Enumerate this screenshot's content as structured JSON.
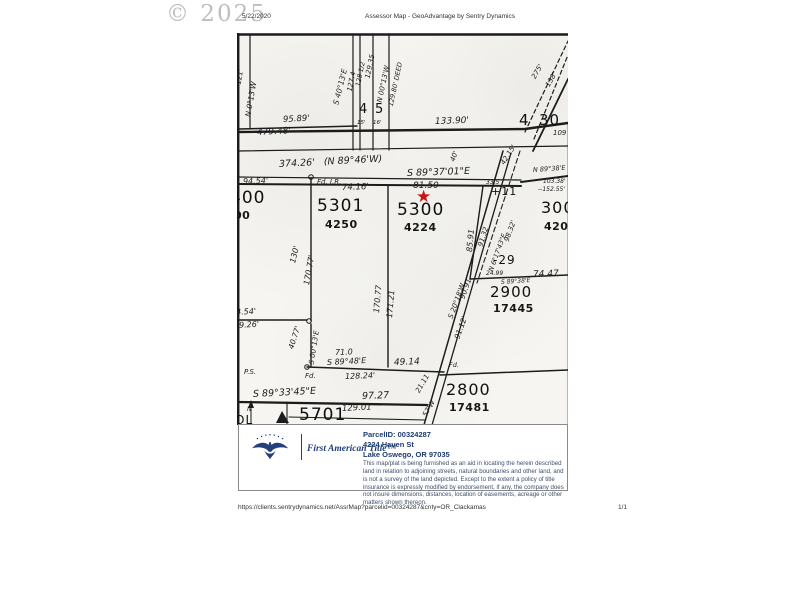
{
  "watermark": "© 2025",
  "header": {
    "date": "5/22/2020",
    "title": "Assessor Map - GeoAdvantage by Sentry Dynamics"
  },
  "footer": {
    "url": "https://clients.sentrydynamics.net/AssrMap?parcelid=00324287&cnty=OR_Clackamas",
    "page": "1/1"
  },
  "info_panel": {
    "brand": "First American Title™",
    "parcel_id": "ParcelID: 00324287",
    "address1": "4224 Haven St",
    "address2": "Lake Oswego, OR  97035",
    "disclaimer": "This map/plat is being furnished as an aid in locating the herein described land in relation to adjoining streets, natural boundaries and other land, and is not a survey of the land depicted. Except to the extent a policy of title insurance is expressly modified by endorsement, if any, the company does not insure dimensions, distances, location of easements, acreage or other matters shown thereon."
  },
  "map": {
    "star_glyph": "★",
    "star_color": "#c81414",
    "labels": [
      {
        "t": "121'",
        "x": 2,
        "y": 48,
        "s": 7,
        "r": -80,
        "c": "d"
      },
      {
        "t": "N 0°13'W",
        "x": 11,
        "y": 80,
        "s": 7.5,
        "r": -80,
        "c": "d"
      },
      {
        "t": "95.89'",
        "x": 46,
        "y": 83,
        "s": 8.5,
        "r": -3,
        "c": "d"
      },
      {
        "t": "479.48'",
        "x": 20,
        "y": 96,
        "s": 9,
        "r": -3,
        "c": "d"
      },
      {
        "t": "S 40°13'E",
        "x": 99,
        "y": 68,
        "s": 7.5,
        "r": -76,
        "c": "d"
      },
      {
        "t": "127.4",
        "x": 113,
        "y": 55,
        "s": 7,
        "r": -78,
        "c": "d"
      },
      {
        "t": "128 1/2",
        "x": 121,
        "y": 50,
        "s": 6.5,
        "r": -78,
        "c": "d"
      },
      {
        "t": "129.35",
        "x": 131,
        "y": 42,
        "s": 7,
        "r": -78,
        "c": "d"
      },
      {
        "t": "N 00°13'W",
        "x": 143,
        "y": 66,
        "s": 7,
        "r": -78,
        "c": "d"
      },
      {
        "t": "129.80' DEED",
        "x": 154,
        "y": 70,
        "s": 6.5,
        "r": -78,
        "c": "d"
      },
      {
        "t": "4",
        "x": 122,
        "y": 70,
        "s": 13,
        "c": "p"
      },
      {
        "t": "5",
        "x": 138,
        "y": 70,
        "s": 13,
        "c": "p"
      },
      {
        "t": "15'",
        "x": 120,
        "y": 88,
        "s": 5.5,
        "c": "d"
      },
      {
        "t": "16'",
        "x": 136,
        "y": 88,
        "s": 5.5,
        "c": "d"
      },
      {
        "t": "133.90'",
        "x": 198,
        "y": 85,
        "s": 9,
        "r": -2,
        "c": "d"
      },
      {
        "t": "4",
        "x": 282,
        "y": 80,
        "s": 15,
        "c": "p"
      },
      {
        "t": "30",
        "x": 302,
        "y": 80,
        "s": 15,
        "c": "p"
      },
      {
        "t": "275'",
        "x": 297,
        "y": 42,
        "s": 7,
        "r": -60,
        "c": "d"
      },
      {
        "t": "138'",
        "x": 311,
        "y": 50,
        "s": 7,
        "r": -60,
        "c": "d"
      },
      {
        "t": "109",
        "x": 316,
        "y": 97,
        "s": 7,
        "c": "d"
      },
      {
        "t": "374.26'   (N 89°46'W)",
        "x": 42,
        "y": 127,
        "s": 9.5,
        "r": -3,
        "c": "d"
      },
      {
        "t": "S 89°37'01\"E",
        "x": 170,
        "y": 136,
        "s": 9.5,
        "r": -2,
        "c": "d"
      },
      {
        "t": "40'",
        "x": 216,
        "y": 125,
        "s": 7,
        "r": -70,
        "c": "d"
      },
      {
        "t": "42.15'",
        "x": 266,
        "y": 128,
        "s": 7,
        "r": -58,
        "c": "d"
      },
      {
        "t": "N 89°38'E",
        "x": 296,
        "y": 134,
        "s": 6.5,
        "r": -4,
        "c": "d"
      },
      {
        "t": "103.38'",
        "x": 306,
        "y": 146,
        "s": 6,
        "c": "d"
      },
      {
        "t": "--152.55'",
        "x": 301,
        "y": 154,
        "s": 6,
        "c": "d"
      },
      {
        "t": "94.54'",
        "x": 6,
        "y": 145,
        "s": 8,
        "r": -2,
        "c": "d"
      },
      {
        "t": "Fd. I.R.",
        "x": 80,
        "y": 146,
        "s": 7,
        "c": "d"
      },
      {
        "t": "74.16'",
        "x": 105,
        "y": 151,
        "s": 8.5,
        "r": -2,
        "c": "d"
      },
      {
        "t": "81.50",
        "x": 176,
        "y": 149,
        "s": 9,
        "c": "d"
      },
      {
        "t": "33.5",
        "x": 249,
        "y": 147,
        "s": 6,
        "c": "d"
      },
      {
        "t": "+11",
        "x": 254,
        "y": 153,
        "s": 11,
        "c": "p"
      },
      {
        "t": "400",
        "x": -7,
        "y": 157,
        "s": 17,
        "c": "p"
      },
      {
        "t": "00",
        "x": -3,
        "y": 177,
        "s": 11,
        "c": "t"
      },
      {
        "t": "5301",
        "x": 80,
        "y": 165,
        "s": 17,
        "c": "p"
      },
      {
        "t": "4250",
        "x": 88,
        "y": 186,
        "s": 11,
        "c": "t"
      },
      {
        "t": "5300",
        "x": 160,
        "y": 169,
        "s": 17,
        "c": "p"
      },
      {
        "t": "4224",
        "x": 167,
        "y": 189,
        "s": 11,
        "c": "t"
      },
      {
        "t": "3000",
        "x": 304,
        "y": 167,
        "s": 16,
        "c": "p"
      },
      {
        "t": "4208",
        "x": 307,
        "y": 188,
        "s": 11,
        "c": "t"
      },
      {
        "t": "85.91",
        "x": 233,
        "y": 215,
        "s": 8,
        "r": -85,
        "c": "d"
      },
      {
        "t": "91.32",
        "x": 244,
        "y": 210,
        "s": 7,
        "r": -73,
        "c": "d"
      },
      {
        "t": "98.32'",
        "x": 270,
        "y": 205,
        "s": 7,
        "r": -70,
        "c": "d"
      },
      {
        "t": "N 6°17'43\"E",
        "x": 254,
        "y": 235,
        "s": 6.5,
        "r": -70,
        "c": "d"
      },
      {
        "t": "-29",
        "x": 256,
        "y": 221,
        "s": 12,
        "c": "p"
      },
      {
        "t": "24.99",
        "x": 249,
        "y": 238,
        "s": 6,
        "c": "d"
      },
      {
        "t": "74.47",
        "x": 296,
        "y": 238,
        "s": 9,
        "r": -2,
        "c": "d"
      },
      {
        "t": "S 89°38'E",
        "x": 264,
        "y": 247,
        "s": 6,
        "r": -4,
        "c": "d"
      },
      {
        "t": "2900",
        "x": 253,
        "y": 252,
        "s": 15,
        "c": "p"
      },
      {
        "t": "17445",
        "x": 256,
        "y": 270,
        "s": 11,
        "c": "t"
      },
      {
        "t": "130'",
        "x": 56,
        "y": 226,
        "s": 8,
        "r": -76,
        "c": "d"
      },
      {
        "t": "170.77'",
        "x": 70,
        "y": 248,
        "s": 8,
        "r": -80,
        "c": "d"
      },
      {
        "t": "170.77",
        "x": 140,
        "y": 276,
        "s": 8,
        "r": -85,
        "c": "d"
      },
      {
        "t": "171.21",
        "x": 153,
        "y": 281,
        "s": 8,
        "r": -85,
        "c": "d"
      },
      {
        "t": "94.54'",
        "x": -6,
        "y": 276,
        "s": 8,
        "r": -3,
        "c": "d"
      },
      {
        "t": "79.26'",
        "x": -3,
        "y": 289,
        "s": 8,
        "r": -3,
        "c": "d"
      },
      {
        "t": "40.77'",
        "x": 54,
        "y": 312,
        "s": 7.5,
        "r": -72,
        "c": "d"
      },
      {
        "t": "S 00°13'E",
        "x": 75,
        "y": 328,
        "s": 7,
        "r": -81,
        "c": "d"
      },
      {
        "t": "71.0",
        "x": 98,
        "y": 316,
        "s": 8,
        "r": -2,
        "c": "d"
      },
      {
        "t": "S 89°48'E",
        "x": 90,
        "y": 326,
        "s": 8,
        "r": -3,
        "c": "d"
      },
      {
        "t": "49.14",
        "x": 157,
        "y": 326,
        "s": 9,
        "r": -2,
        "c": "d"
      },
      {
        "t": "P.S.",
        "x": 7,
        "y": 336,
        "s": 7,
        "c": "d"
      },
      {
        "t": "Fd.",
        "x": 68,
        "y": 340,
        "s": 7,
        "c": "d"
      },
      {
        "t": "128.24'",
        "x": 108,
        "y": 340,
        "s": 8,
        "r": -2,
        "c": "d"
      },
      {
        "t": "S 89°33'45\"E",
        "x": 16,
        "y": 357,
        "s": 9.5,
        "r": -3,
        "c": "d"
      },
      {
        "t": "97.27",
        "x": 125,
        "y": 359,
        "s": 9.5,
        "r": -2,
        "c": "d"
      },
      {
        "t": "129.01",
        "x": 105,
        "y": 372,
        "s": 8.5,
        "r": -3,
        "c": "d"
      },
      {
        "t": "5701",
        "x": 62,
        "y": 374,
        "s": 17,
        "c": "p"
      },
      {
        "t": "N",
        "x": 10,
        "y": 374,
        "s": 6,
        "c": "d"
      },
      {
        "t": "OL",
        "x": -2,
        "y": 381,
        "s": 12,
        "c": "p"
      },
      {
        "t": "S 20°18'W",
        "x": 214,
        "y": 282,
        "s": 7,
        "r": -70,
        "c": "d"
      },
      {
        "t": "90.91",
        "x": 225,
        "y": 262,
        "s": 7.5,
        "r": -70,
        "c": "d"
      },
      {
        "t": "91.12'",
        "x": 220,
        "y": 302,
        "s": 7.5,
        "r": -70,
        "c": "d"
      },
      {
        "t": "Fd.",
        "x": 212,
        "y": 329,
        "s": 6.5,
        "c": "d"
      },
      {
        "t": "21.11",
        "x": 181,
        "y": 356,
        "s": 7,
        "r": -60,
        "c": "d"
      },
      {
        "t": "57'W",
        "x": 188,
        "y": 380,
        "s": 7,
        "r": -60,
        "c": "d"
      },
      {
        "t": "2800",
        "x": 209,
        "y": 349,
        "s": 16,
        "c": "p"
      },
      {
        "t": "17481",
        "x": 212,
        "y": 369,
        "s": 11,
        "c": "t"
      }
    ]
  }
}
